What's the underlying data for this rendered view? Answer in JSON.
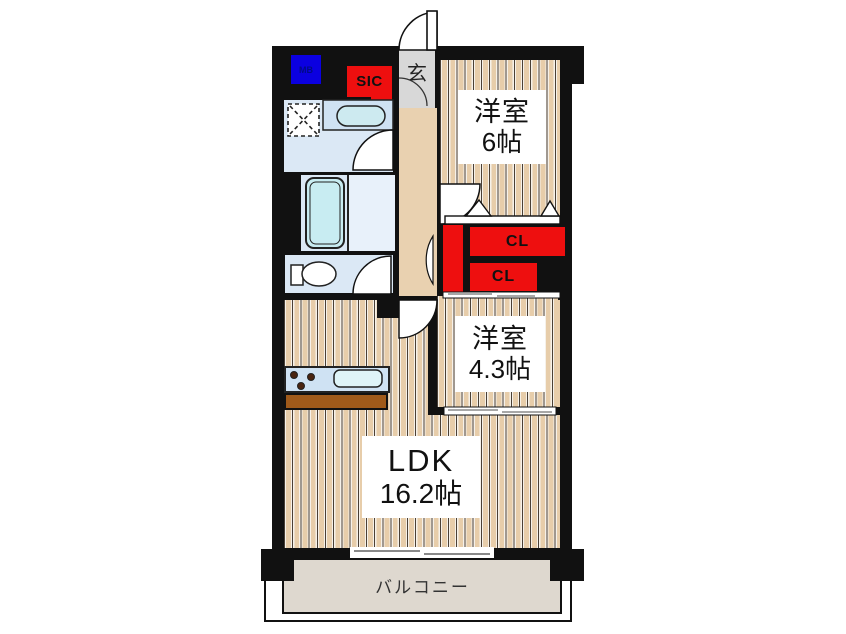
{
  "floorplan": {
    "rooms": {
      "western_room_1": {
        "name": "洋室",
        "size": "6帖"
      },
      "western_room_2": {
        "name": "洋室",
        "size": "4.3帖"
      },
      "ldk": {
        "name": "LDK",
        "size": "16.2帖"
      },
      "balcony": {
        "name": "バルコニー"
      },
      "entrance": {
        "name": "玄"
      },
      "shoe_closet": {
        "name": "SIC"
      },
      "meter_box": {
        "name": "MB"
      },
      "closet_upper": {
        "name": "CL"
      },
      "closet_lower": {
        "name": "CL"
      }
    },
    "colors": {
      "wall": "#111111",
      "wood_floor": "#e7cdaa",
      "closet_red": "#ee0f0f",
      "meter_box_blue": "#0b00e0",
      "wet_area_blue": "#dbe8f5",
      "tub_cyan": "#c8ecf2",
      "entrance_gray": "#d8d8d8",
      "balcony_beige": "#ded8cf",
      "counter_brown": "#a05a1a"
    }
  }
}
